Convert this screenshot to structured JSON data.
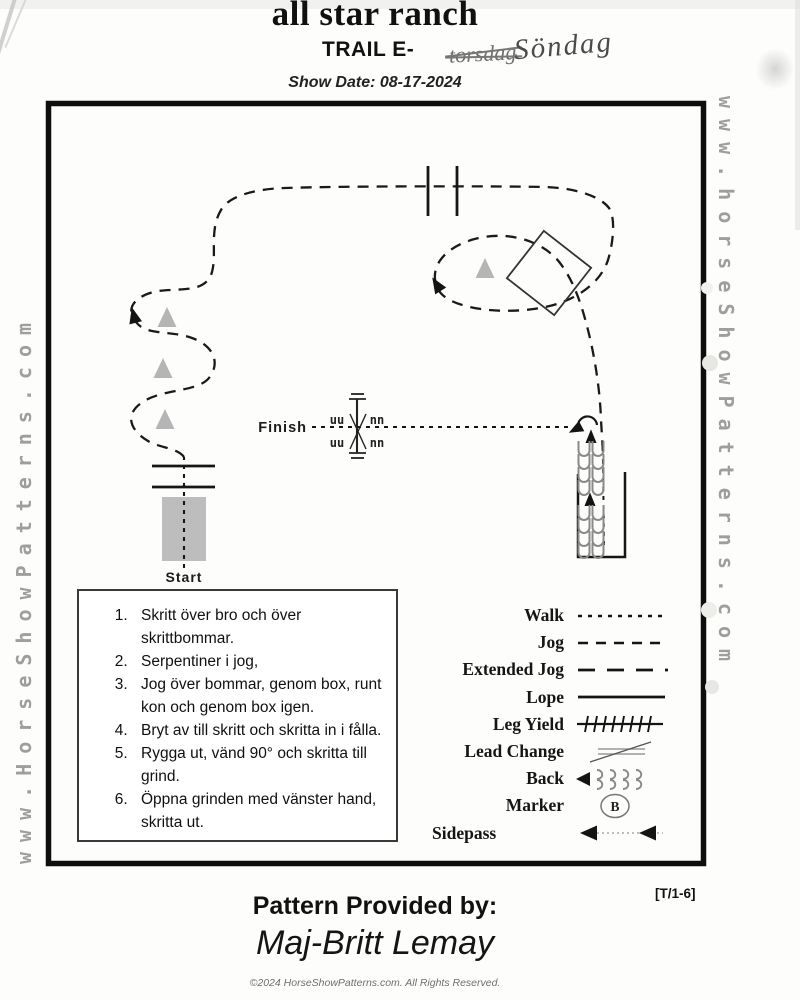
{
  "header": {
    "title": "all star ranch",
    "class_label": "TRAIL E-",
    "crossed_out_word": "torsdag",
    "handwritten_day": "Söndag",
    "show_date": "Show Date: 08-17-2024"
  },
  "watermarks": {
    "left": "www.HorseShowPatterns.com",
    "right": "www.horseShowPatterns.com"
  },
  "course": {
    "start_label": "Start",
    "finish_label": "Finish",
    "gate_front_marks": "uu",
    "gate_back_marks": "nn"
  },
  "instructions": {
    "items": [
      "Skritt över bro och över skrittbommar.",
      "Serpentiner i jog,",
      "Jog över bommar, genom box, runt kon och genom box igen.",
      "Bryt av till skritt och skritta in i fålla.",
      "Rygga ut, vänd 90° och skritta till grind.",
      "Öppna grinden med vänster hand, skritta ut."
    ]
  },
  "legend": {
    "marker_letter": "B",
    "entries": [
      {
        "label": "Walk",
        "symbol": "walk-dashes"
      },
      {
        "label": "Jog",
        "symbol": "jog-dashes"
      },
      {
        "label": "Extended Jog",
        "symbol": "extended-jog-dashes"
      },
      {
        "label": "Lope",
        "symbol": "solid-line"
      },
      {
        "label": "Leg Yield",
        "symbol": "crosshatch-line"
      },
      {
        "label": "Lead Change",
        "symbol": "slash-over-lines"
      },
      {
        "label": "Back",
        "symbol": "hoofprints-arrow"
      },
      {
        "label": "Marker",
        "symbol": "lettered-circle"
      },
      {
        "label": "Sidepass",
        "symbol": "double-left-arrows"
      }
    ]
  },
  "footer": {
    "pattern_code": "[T/1-6]",
    "provided_by_label": "Pattern Provided by:",
    "provided_by_name": "Maj-Britt Lemay",
    "copyright": "©2024 HorseShowPatterns.com. All Rights Reserved."
  },
  "colors": {
    "ink": "#111111",
    "watermark_gray": "#9e9e9e",
    "obstacle_gray": "#b5b5b5",
    "handwriting_gray": "#4a4a4a"
  }
}
